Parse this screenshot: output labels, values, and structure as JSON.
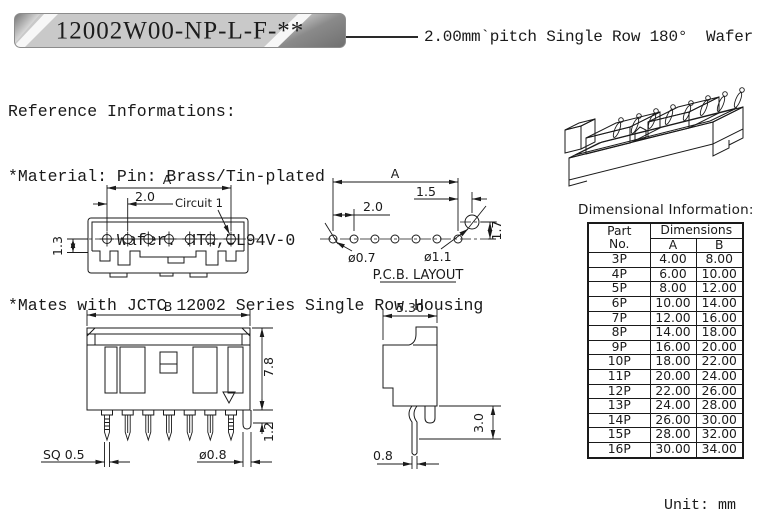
{
  "banner": {
    "part_number": "12002W00-NP-L-F-**"
  },
  "subtitle": "2.00mm`pitch Single Row 180°  Wafer",
  "reference": {
    "title": "Reference Informations:",
    "material_line": "*Material: Pin: Brass/Tin-plated",
    "wafer_line": "Wafer: HTN,UL94V-0",
    "mates_line": "*Mates with JCTC 12002 Series Single Row Housing"
  },
  "top_view": {
    "dim_a": "A",
    "dim_pitch": "2.0",
    "circuit_label": "Circuit 1",
    "dim_row": "1.3"
  },
  "pcb_layout": {
    "dim_a": "A",
    "dim_offset": "1.5",
    "dim_pitch": "2.0",
    "dim_hole_small": "ø0.7",
    "dim_hole_large": "ø1.1",
    "dim_vertical": "1.7",
    "caption": "P.C.B. LAYOUT"
  },
  "front_view": {
    "dim_b": "B",
    "dim_height": "7.8",
    "dim_standoff": "1.2",
    "dim_pin_sq": "SQ 0.5",
    "dim_peg_dia": "ø0.8"
  },
  "side_view": {
    "dim_depth": "5.30",
    "dim_tail": "3.0",
    "dim_pin_thickness": "0.8"
  },
  "table": {
    "title": "Dimensional Information:",
    "headers": {
      "part": "Part",
      "no": "No.",
      "dims": "Dimensions",
      "a": "A",
      "b": "B"
    },
    "rows": [
      {
        "part": "3P",
        "a": "4.00",
        "b": "8.00"
      },
      {
        "part": "4P",
        "a": "6.00",
        "b": "10.00"
      },
      {
        "part": "5P",
        "a": "8.00",
        "b": "12.00"
      },
      {
        "part": "6P",
        "a": "10.00",
        "b": "14.00"
      },
      {
        "part": "7P",
        "a": "12.00",
        "b": "16.00"
      },
      {
        "part": "8P",
        "a": "14.00",
        "b": "18.00"
      },
      {
        "part": "9P",
        "a": "16.00",
        "b": "20.00"
      },
      {
        "part": "10P",
        "a": "18.00",
        "b": "22.00"
      },
      {
        "part": "11P",
        "a": "20.00",
        "b": "24.00"
      },
      {
        "part": "12P",
        "a": "22.00",
        "b": "26.00"
      },
      {
        "part": "13P",
        "a": "24.00",
        "b": "28.00"
      },
      {
        "part": "14P",
        "a": "26.00",
        "b": "30.00"
      },
      {
        "part": "15P",
        "a": "28.00",
        "b": "32.00"
      },
      {
        "part": "16P",
        "a": "30.00",
        "b": "34.00"
      }
    ],
    "unit": "Unit: mm"
  }
}
